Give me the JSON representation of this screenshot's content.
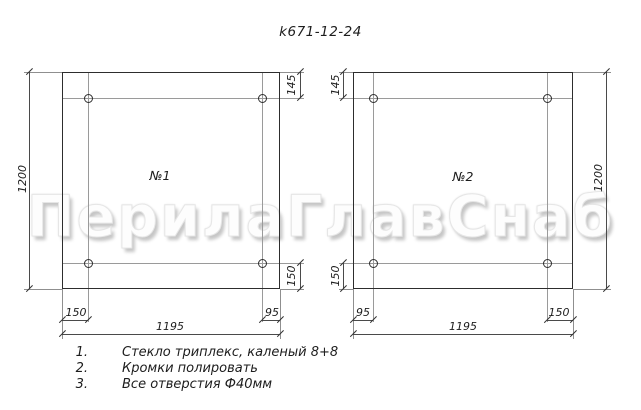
{
  "title": "k671-12-24",
  "watermark": {
    "text": "ПерилаГлавСнаб"
  },
  "panels": [
    {
      "label": "№1",
      "height": "1200",
      "width": "1195",
      "top_offset": "145",
      "bottom_offset": "150",
      "left_inset": "150",
      "right_inset": "95"
    },
    {
      "label": "№2",
      "height": "1200",
      "width": "1195",
      "top_offset": "145",
      "bottom_offset": "150",
      "left_inset": "95",
      "right_inset": "150"
    }
  ],
  "notes": [
    {
      "num": "1.",
      "text": "Стекло триплекс, каленый 8+8"
    },
    {
      "num": "2.",
      "text": "Кромки полировать"
    },
    {
      "num": "3.",
      "text": "Все отверстия Ф40мм"
    }
  ],
  "colors": {
    "line": "#2d2d2d",
    "dim_line": "#4a4a4a",
    "thin_line": "#8f8f8f",
    "text": "#1d1d1d",
    "watermark_fill": "#fdfdfd",
    "watermark_shadow": "#c6c6c6"
  }
}
